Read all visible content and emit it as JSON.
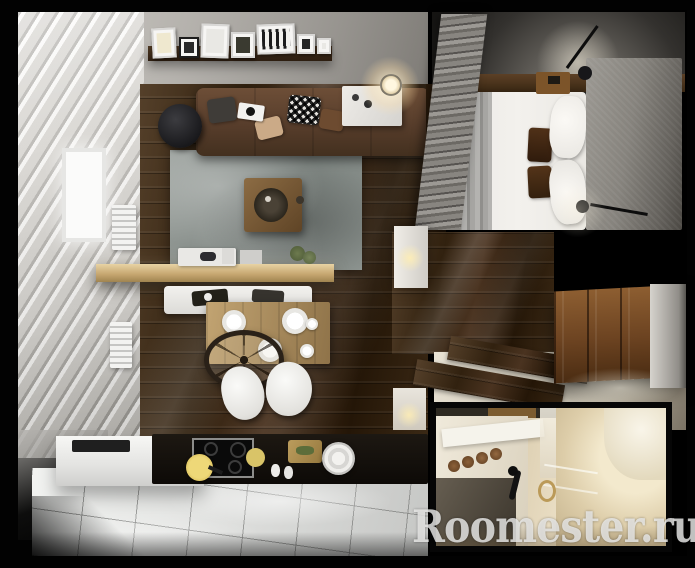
{
  "type": "interior-3d-render-top-view",
  "title": "Studio apartment floor plan, top-down 3D render",
  "watermark": {
    "text": "Roomester.ru",
    "color": "#ececea",
    "position": "bottom-right",
    "style": "semi-transparent serif"
  },
  "frame": {
    "background": "#000000",
    "width_px": 695,
    "height_px": 568
  },
  "rooms": {
    "living_room": {
      "position": "top-left",
      "objects": [
        "brown corner sofa with assorted pillows",
        "wall shelf with seven picture frames",
        "grey marbled rug",
        "wooden coffee table with round black tray",
        "black round side table",
        "white curtains and window",
        "two white radiators",
        "grey pleated curtain room divider",
        "glowing pendant lamp",
        "white side cabinet with candles"
      ]
    },
    "kitchen_dining": {
      "position": "bottom-left",
      "objects": [
        "light wood bar counter with tray and plant",
        "white bench with black trays",
        "wooden dining table with white plates",
        "wire-wheel pendant over table",
        "two white shell chairs",
        "black worktop with induction hob",
        "yellow pan",
        "round yellow board",
        "wooden cutting board",
        "round white sink",
        "white corner counter with dark sink slot",
        "white glossy floor tiles"
      ]
    },
    "bedroom": {
      "position": "top-right",
      "objects": [
        "double bed with white duvet",
        "striped grey blanket at foot",
        "two dark brown accent pillows",
        "two white pillows",
        "grey fabric headboard wall",
        "wooden nightstand",
        "two black wall sconces with warm glow",
        "dark ceiling"
      ]
    },
    "hallway": {
      "position": "right-middle",
      "objects": [
        "dark laminate accent wall seen from above",
        "wooden wardrobe with panelled doors",
        "cream entry floor",
        "two dark wood runner planks",
        "glowing wall lamp panels",
        "white side wall"
      ]
    },
    "bathroom_inset": {
      "position": "bottom-right",
      "kind": "inset photo",
      "objects": [
        "beige marble walls",
        "white vanity with rolled brown towels",
        "dark vanity counter",
        "black faucet",
        "gold towel ring with towel",
        "white bathtub",
        "chrome rails"
      ]
    }
  },
  "palette": {
    "background": "#000000",
    "wood_floor": "#3b2917",
    "accent_wood": "#5a3c20",
    "sofa_brown": "#5a4130",
    "rug_grey": "#8a918e",
    "tile_white": "#e6e7e5",
    "bed_white": "#efede9",
    "curtain_grey": "#8e8b86",
    "bar_wood": "#c9ac74",
    "counter_black": "#14100c",
    "bath_cream": "#dccfb2",
    "watermark_white": "#ececea"
  }
}
